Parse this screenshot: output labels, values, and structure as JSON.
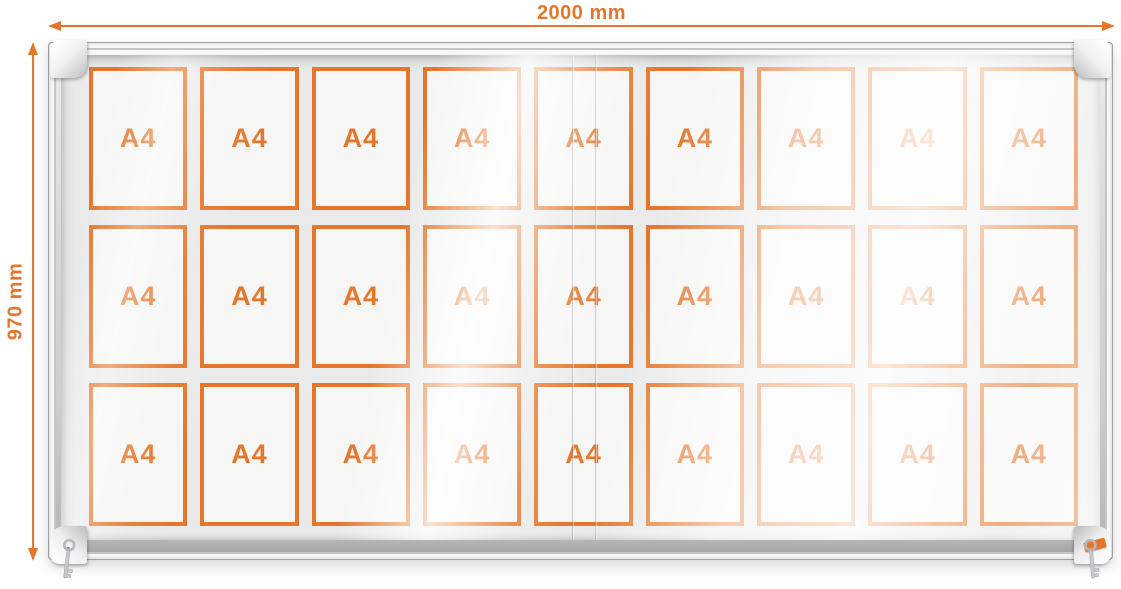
{
  "dimensions": {
    "width_label": "2000 mm",
    "height_label": "970 mm"
  },
  "showcase": {
    "rows": 3,
    "columns": 9,
    "slot_count": 27,
    "slots": [
      "A4",
      "A4",
      "A4",
      "A4",
      "A4",
      "A4",
      "A4",
      "A4",
      "A4",
      "A4",
      "A4",
      "A4",
      "A4",
      "A4",
      "A4",
      "A4",
      "A4",
      "A4",
      "A4",
      "A4",
      "A4",
      "A4",
      "A4",
      "A4",
      "A4",
      "A4",
      "A4"
    ]
  },
  "icons": {
    "width_arrow": "double-headed-arrow-icon",
    "height_arrow": "double-headed-arrow-icon",
    "left_key": "key-icon",
    "right_key": "key-icon",
    "brand_badge": "orange-brand-badge"
  },
  "colors": {
    "accent_orange": "#E5762B",
    "frame_silver": "#D4D4D4",
    "glass_grey": "#E9EAE9"
  }
}
